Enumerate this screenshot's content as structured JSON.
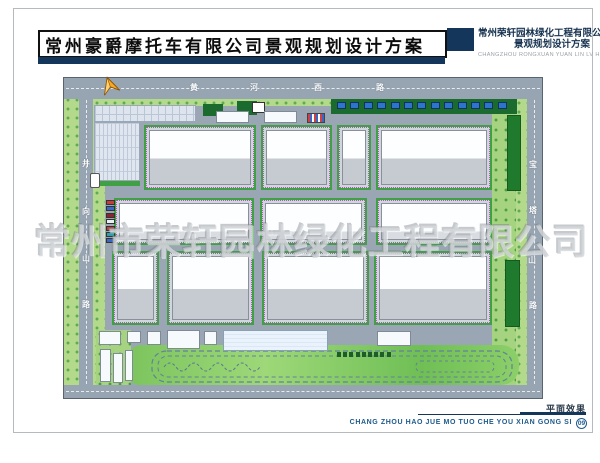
{
  "header": {
    "title": "常州豪爵摩托车有限公司景观规划设计方案",
    "company_block": {
      "line1": "常州荣轩园林绿化工程有限公司",
      "line2": "景观规划设计方案",
      "line3": "CHANGZHOU RONGXUAN YUAN LIN LV HUA"
    },
    "accent_color": "#14365a"
  },
  "map": {
    "watermark": "常州市荣轩园林绿化工程有限公司",
    "roads": {
      "top": {
        "name": "黄河西路",
        "chars": [
          "黄",
          "河",
          "西",
          "路"
        ]
      },
      "left": {
        "name": "井向山路",
        "chars": [
          "井",
          "向",
          "山",
          "路"
        ]
      },
      "right": {
        "name": "宝塔山路",
        "chars": [
          "宝",
          "塔",
          "山",
          "路"
        ]
      }
    },
    "north_arrow_icon": "north-arrow-icon",
    "car_colors": [
      "#c93b3b",
      "#3a66c8",
      "#8b2430",
      "#e8f0f4",
      "#c93b3b",
      "#2f9fae",
      "#3a66c8"
    ],
    "entrance_car_colors": [
      "#c93b3b",
      "#3a66c8",
      "#3a66c8",
      "#2f9fae"
    ],
    "canopy_panel_count": 13,
    "hedge_square_count": 9,
    "colors": {
      "road_gray": "#97a4b1",
      "verge_green": "#b3da8b",
      "dark_green": "#1f7a2e",
      "hedge_green": "#3fa044",
      "panel_blue": "#2f74cc",
      "accent_navy": "#14365a"
    }
  },
  "footer": {
    "caption": "平面效果",
    "company_en": "CHANG ZHOU HAO JUE MO TUO CHE YOU XIAN GONG SI",
    "page_number": "09"
  }
}
